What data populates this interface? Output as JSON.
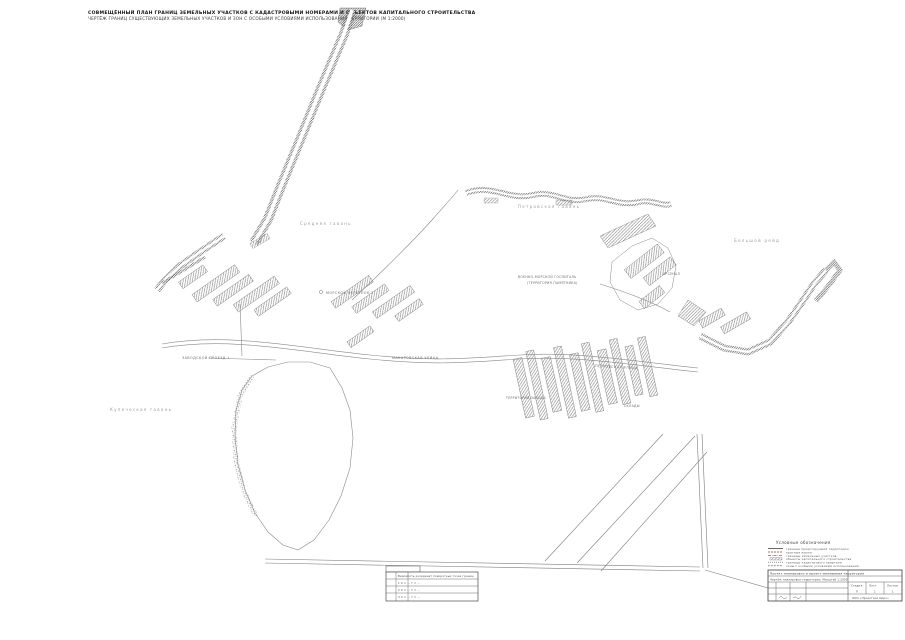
{
  "header": {
    "line1": "СОВМЕЩЁННЫЙ ПЛАН ГРАНИЦ ЗЕМЕЛЬНЫХ УЧАСТКОВ С КАДАСТРОВЫМИ НОМЕРАМИ И ОБЪЕКТОВ КАПИТАЛЬНОГО СТРОИТЕЛЬСТВА",
    "line2": "ЧЕРТЁЖ ГРАНИЦ СУЩЕСТВУЮЩИХ ЗЕМЕЛЬНЫХ УЧАСТКОВ И ЗОН С ОСОБЫМИ УСЛОВИЯМИ ИСПОЛЬЗОВАНИЯ ТЕРРИТОРИИ (М 1:2000)"
  },
  "map": {
    "water_labels": {
      "nw": "Средняя гавань",
      "n": "Петровская гавань",
      "w": "Купеческая гавань",
      "e": "Большой рейд"
    },
    "street_labels": {
      "lane": "МОРСКОЙ ПЕРЕУЛОК 1",
      "drive": "ЗАВОДСКОЙ ПРОЕЗД 1",
      "street_main": "МАКАРОВСКАЯ УЛИЦА",
      "street_south": "ПЕТРОВСКАЯ УЛИЦА"
    },
    "area_labels": {
      "district_line1": "ВОЕННО-МОРСКОЙ ГОСПИТАЛЬ",
      "district_line2": "(ТЕРРИТОРИЯ ПАМЯТНИКА)",
      "fort": "АРСЕНАЛ",
      "block_a": "ТЕРРИТОРИЯ ЗАВОДА",
      "block_b": "СКЛАДЫ"
    }
  },
  "legend": {
    "title": "Условные обозначения",
    "items": [
      "граница проектируемой территории",
      "красные линии",
      "границы земельных участков",
      "объекты капитального строительства",
      "границы кадастрового квартала",
      "зоны с особыми условиями использования"
    ]
  },
  "title_block": {
    "project": "Проект планировки и проект межевания территории",
    "doc": "Чертёж планировки территории. Масштаб 1:2000",
    "org": "ООО «Проектное бюро»",
    "stage_label": "Стадия",
    "stage_value": "П",
    "sheet_label": "Лист",
    "sheet_value": "1",
    "sheets_label": "Листов",
    "sheets_value": "1"
  },
  "coords_table": {
    "title": "Ведомость координат поворотных точек границ",
    "rows": [
      "1    X = …    Y = …",
      "2    X = …    Y = …",
      "3    X = …    Y = …"
    ]
  }
}
